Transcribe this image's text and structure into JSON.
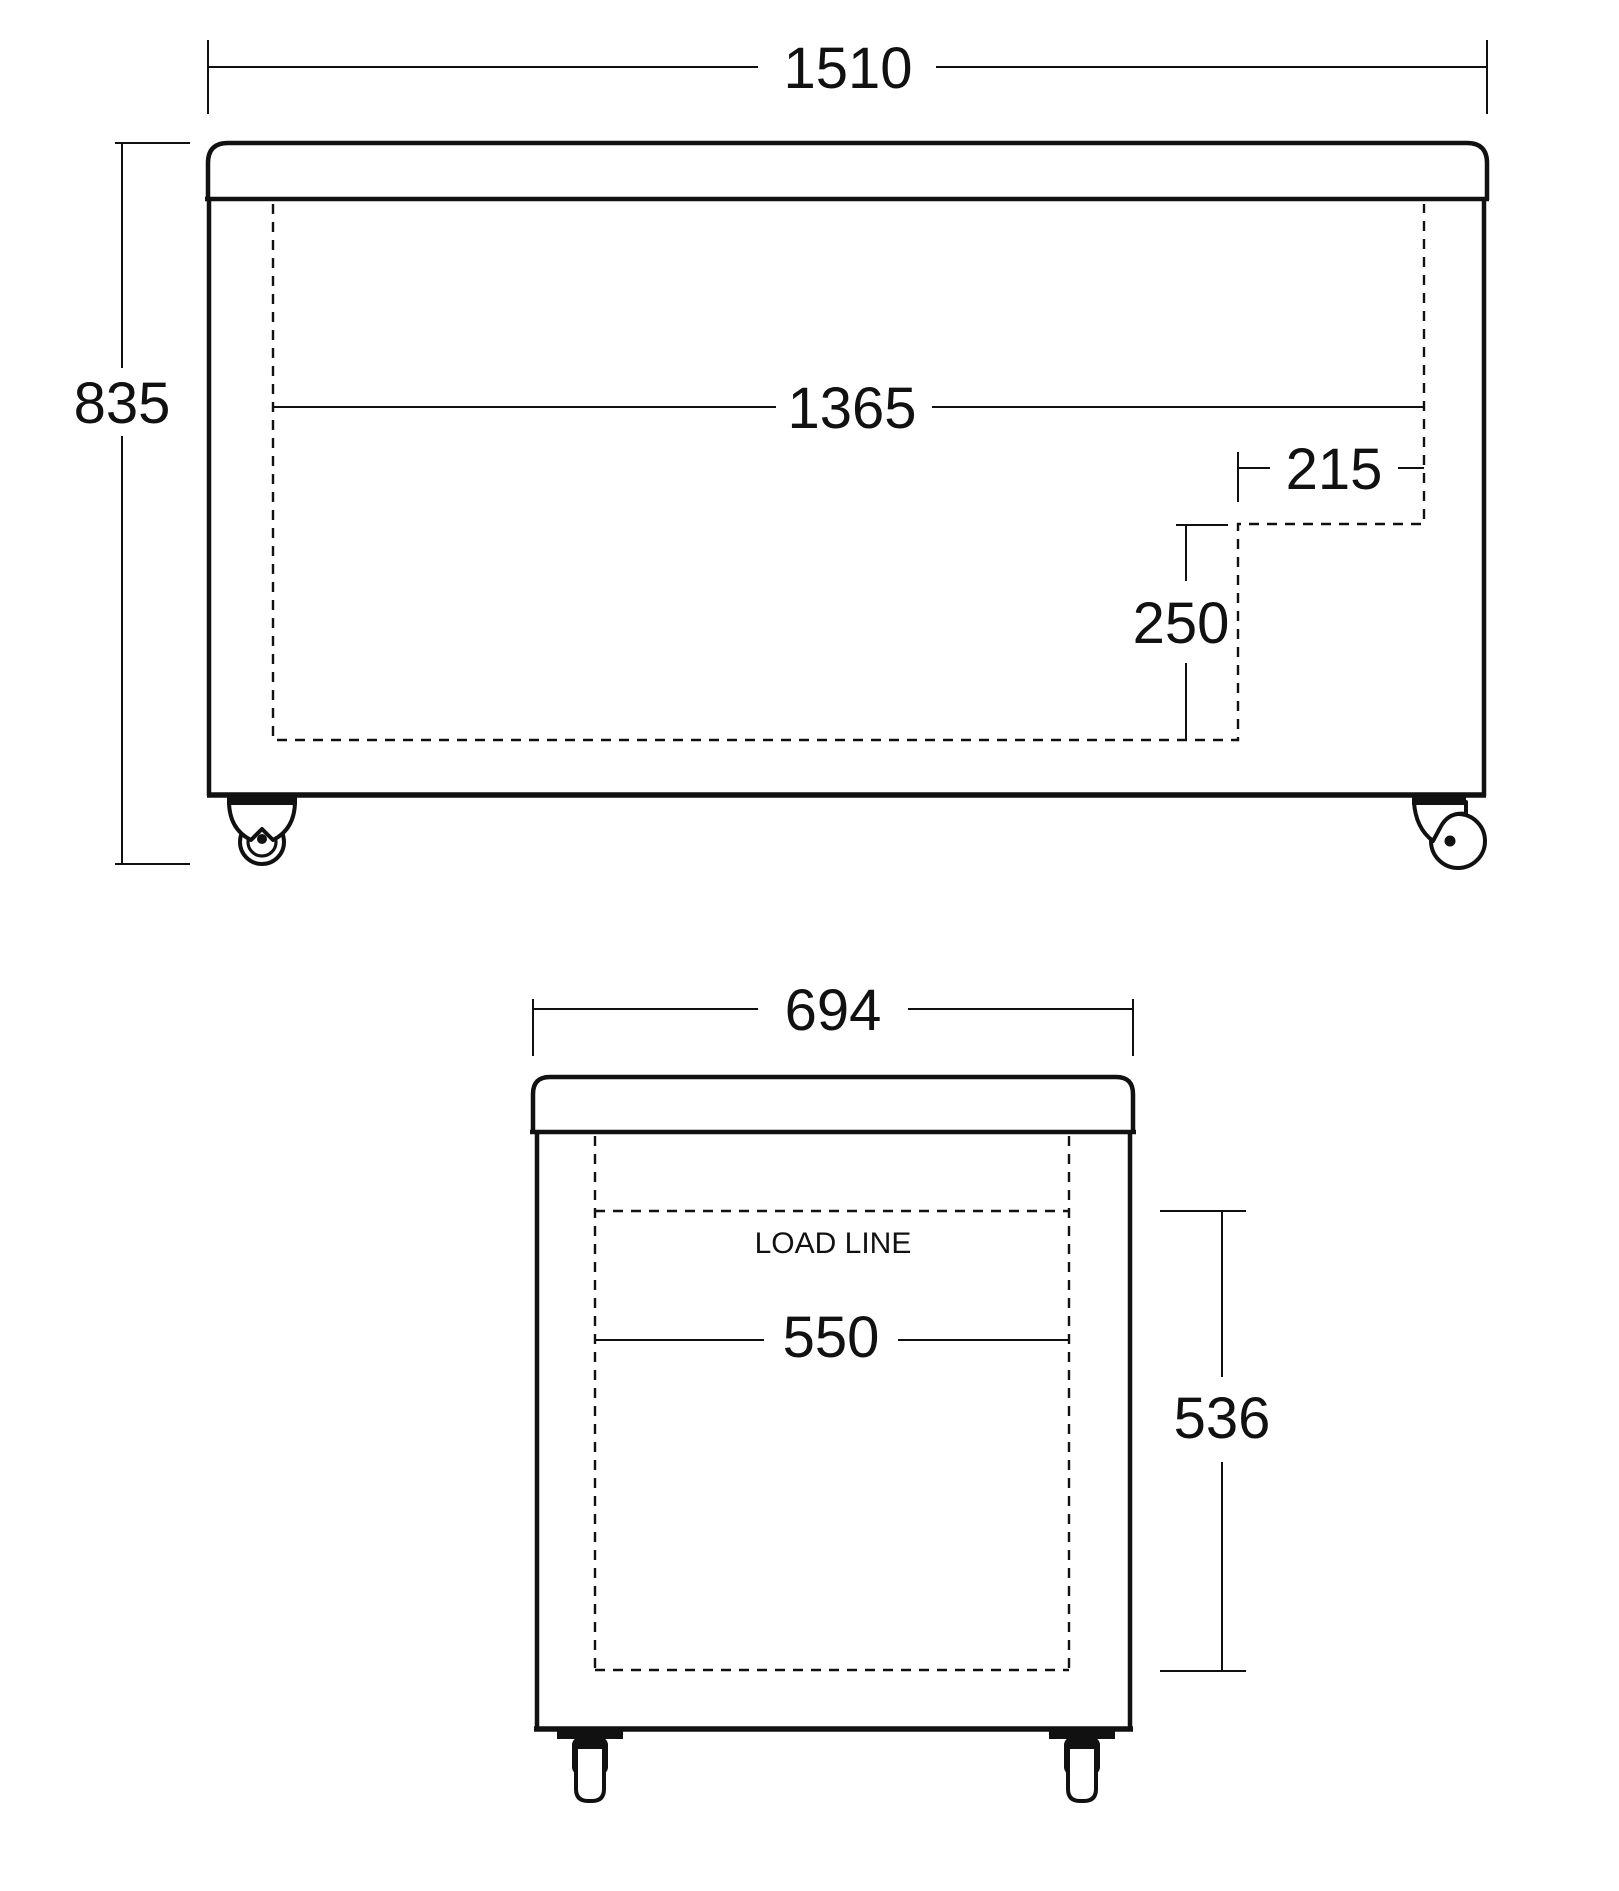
{
  "drawing": {
    "title": "chest-freezer-dimension-diagram",
    "colors": {
      "line": "#111111",
      "background": "#ffffff"
    },
    "front_view": {
      "overall_width": "1510",
      "overall_height": "835",
      "interior_width": "1365",
      "step_width": "215",
      "step_height": "250"
    },
    "end_view": {
      "overall_width": "694",
      "interior_width": "550",
      "interior_height": "536",
      "load_line": "LOAD LINE"
    }
  }
}
